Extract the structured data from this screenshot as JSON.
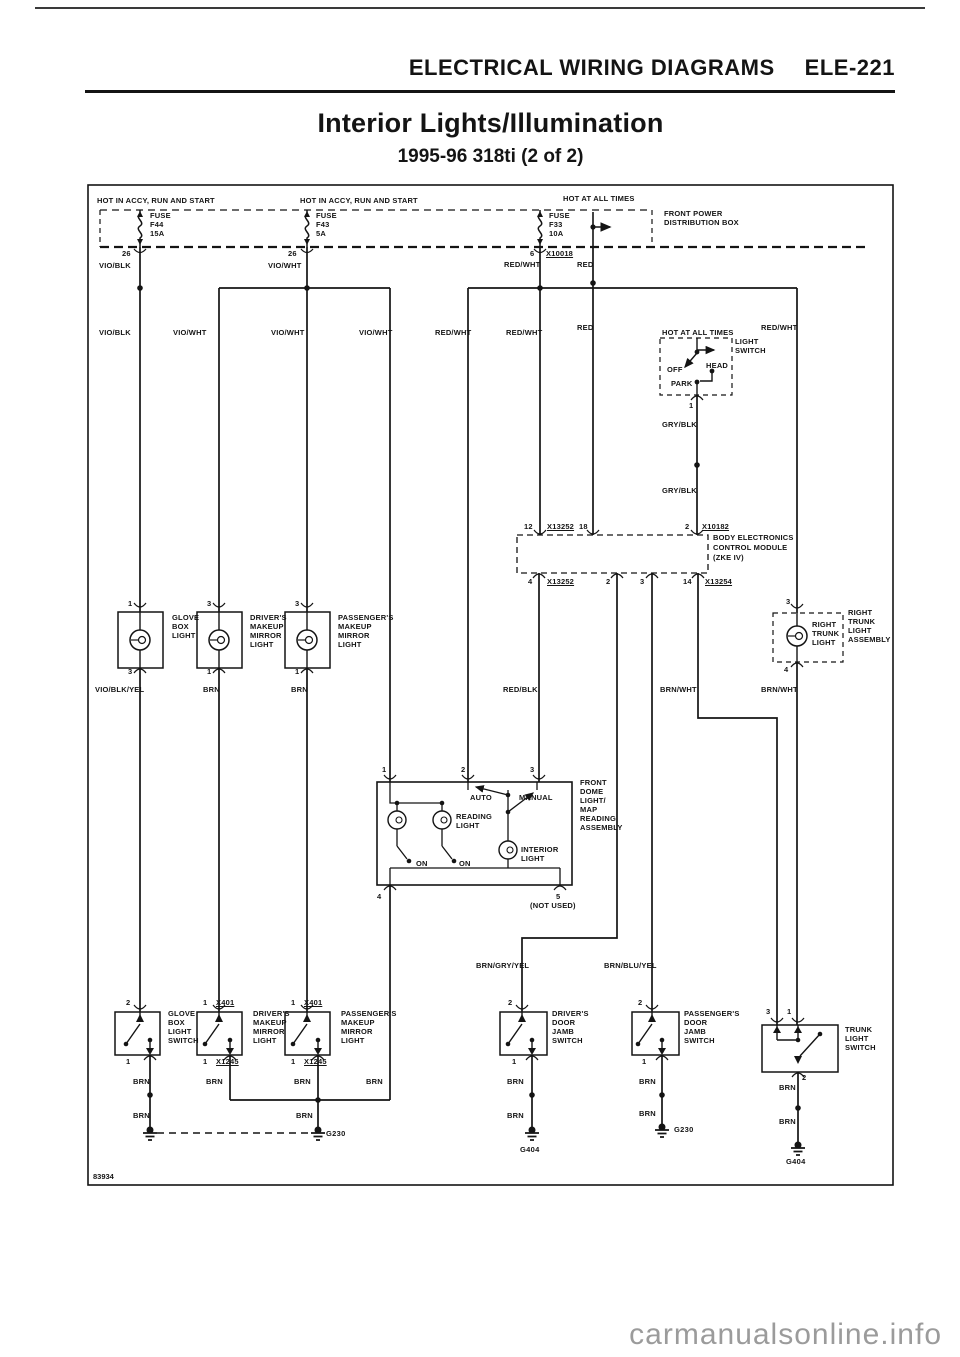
{
  "page": {
    "header": "ELECTRICAL WIRING DIAGRAMS",
    "page_code": "ELE-221",
    "title": "Interior Lights/Illumination",
    "subtitle": "1995-96 318ti (2 of 2)",
    "figure_number": "83934",
    "watermark": "carmanualsonline.info"
  },
  "diagram": {
    "components": [
      "FRONT POWER DISTRIBUTION BOX",
      "LIGHT SWITCH",
      "BODY ELECTRONICS CONTROL MODULE (ZKE IV)",
      "GLOVE BOX LIGHT",
      "DRIVER'S MAKEUP MIRROR LIGHT",
      "PASSENGER'S MAKEUP MIRROR LIGHT",
      "RIGHT TRUNK LIGHT ASSEMBLY",
      "FRONT DOME LIGHT/MAP READING ASSEMBLY",
      "GLOVE BOX LIGHT SWITCH",
      "DRIVER'S DOOR JAMB SWITCH",
      "PASSENGER'S DOOR JAMB SWITCH",
      "TRUNK LIGHT SWITCH"
    ],
    "labels": [
      {
        "t": "HOT IN ACCY, RUN AND START",
        "x": 97,
        "y": 197,
        "c": "p"
      },
      {
        "t": "HOT IN ACCY, RUN AND START",
        "x": 300,
        "y": 197,
        "c": "p"
      },
      {
        "t": "HOT AT ALL TIMES",
        "x": 563,
        "y": 195,
        "c": "p"
      },
      {
        "t": "FUSE",
        "x": 150,
        "y": 212,
        "c": "f"
      },
      {
        "t": "F44",
        "x": 150,
        "y": 221,
        "c": "f"
      },
      {
        "t": "15A",
        "x": 150,
        "y": 230,
        "c": "f"
      },
      {
        "t": "FUSE",
        "x": 316,
        "y": 212,
        "c": "f"
      },
      {
        "t": "F43",
        "x": 316,
        "y": 221,
        "c": "f"
      },
      {
        "t": "5A",
        "x": 316,
        "y": 230,
        "c": "f"
      },
      {
        "t": "FUSE",
        "x": 549,
        "y": 212,
        "c": "f"
      },
      {
        "t": "F33",
        "x": 549,
        "y": 221,
        "c": "f"
      },
      {
        "t": "10A",
        "x": 549,
        "y": 230,
        "c": "f"
      },
      {
        "t": "FRONT POWER",
        "x": 664,
        "y": 210,
        "c": "c"
      },
      {
        "t": "DISTRIBUTION BOX",
        "x": 664,
        "y": 219,
        "c": "c"
      },
      {
        "t": "26",
        "x": 122,
        "y": 250,
        "c": "n"
      },
      {
        "t": "26",
        "x": 288,
        "y": 250,
        "c": "n"
      },
      {
        "t": "6",
        "x": 530,
        "y": 250,
        "c": "n"
      },
      {
        "t": "X10018",
        "x": 546,
        "y": 250,
        "c": "x"
      },
      {
        "t": "VIO/BLK",
        "x": 99,
        "y": 262,
        "c": "w"
      },
      {
        "t": "VIO/WHT",
        "x": 268,
        "y": 262,
        "c": "w"
      },
      {
        "t": "RED/WHT",
        "x": 504,
        "y": 261,
        "c": "w"
      },
      {
        "t": "RED",
        "x": 577,
        "y": 261,
        "c": "w"
      },
      {
        "t": "VIO/BLK",
        "x": 99,
        "y": 329,
        "c": "w"
      },
      {
        "t": "VIO/WHT",
        "x": 173,
        "y": 329,
        "c": "w"
      },
      {
        "t": "VIO/WHT",
        "x": 271,
        "y": 329,
        "c": "w"
      },
      {
        "t": "VIO/WHT",
        "x": 359,
        "y": 329,
        "c": "w"
      },
      {
        "t": "RED/WHT",
        "x": 435,
        "y": 329,
        "c": "w"
      },
      {
        "t": "RED/WHT",
        "x": 506,
        "y": 329,
        "c": "w"
      },
      {
        "t": "RED",
        "x": 577,
        "y": 324,
        "c": "w"
      },
      {
        "t": "RED/WHT",
        "x": 761,
        "y": 324,
        "c": "w"
      },
      {
        "t": "HOT AT ALL TIMES",
        "x": 662,
        "y": 329,
        "c": "p"
      },
      {
        "t": "LIGHT",
        "x": 735,
        "y": 338,
        "c": "c"
      },
      {
        "t": "SWITCH",
        "x": 735,
        "y": 347,
        "c": "c"
      },
      {
        "t": "OFF",
        "x": 667,
        "y": 366,
        "c": "m"
      },
      {
        "t": "HEAD",
        "x": 706,
        "y": 362,
        "c": "m"
      },
      {
        "t": "PARK",
        "x": 671,
        "y": 380,
        "c": "m"
      },
      {
        "t": "1",
        "x": 689,
        "y": 402,
        "c": "n"
      },
      {
        "t": "GRY/BLK",
        "x": 662,
        "y": 421,
        "c": "w"
      },
      {
        "t": "GRY/BLK",
        "x": 662,
        "y": 487,
        "c": "w"
      },
      {
        "t": "12",
        "x": 524,
        "y": 523,
        "c": "n"
      },
      {
        "t": "X13252",
        "x": 547,
        "y": 523,
        "c": "x"
      },
      {
        "t": "18",
        "x": 579,
        "y": 523,
        "c": "n"
      },
      {
        "t": "2",
        "x": 685,
        "y": 523,
        "c": "n"
      },
      {
        "t": "X10182",
        "x": 702,
        "y": 523,
        "c": "x"
      },
      {
        "t": "BODY ELECTRONICS",
        "x": 713,
        "y": 534,
        "c": "c"
      },
      {
        "t": "CONTROL MODULE",
        "x": 713,
        "y": 544,
        "c": "c"
      },
      {
        "t": "(ZKE IV)",
        "x": 713,
        "y": 554,
        "c": "c"
      },
      {
        "t": "4",
        "x": 528,
        "y": 578,
        "c": "n"
      },
      {
        "t": "X13252",
        "x": 547,
        "y": 578,
        "c": "x"
      },
      {
        "t": "2",
        "x": 606,
        "y": 578,
        "c": "n"
      },
      {
        "t": "3",
        "x": 640,
        "y": 578,
        "c": "n"
      },
      {
        "t": "14",
        "x": 683,
        "y": 578,
        "c": "n"
      },
      {
        "t": "X13254",
        "x": 705,
        "y": 578,
        "c": "x"
      },
      {
        "t": "3",
        "x": 786,
        "y": 598,
        "c": "n"
      },
      {
        "t": "1",
        "x": 128,
        "y": 600,
        "c": "n"
      },
      {
        "t": "3",
        "x": 207,
        "y": 600,
        "c": "n"
      },
      {
        "t": "3",
        "x": 295,
        "y": 600,
        "c": "n"
      },
      {
        "t": "GLOVE",
        "x": 172,
        "y": 614,
        "c": "c"
      },
      {
        "t": "BOX",
        "x": 172,
        "y": 623,
        "c": "c"
      },
      {
        "t": "LIGHT",
        "x": 172,
        "y": 632,
        "c": "c"
      },
      {
        "t": "DRIVER'S",
        "x": 250,
        "y": 614,
        "c": "c"
      },
      {
        "t": "MAKEUP",
        "x": 250,
        "y": 623,
        "c": "c"
      },
      {
        "t": "MIRROR",
        "x": 250,
        "y": 632,
        "c": "c"
      },
      {
        "t": "LIGHT",
        "x": 250,
        "y": 641,
        "c": "c"
      },
      {
        "t": "PASSENGER'S",
        "x": 338,
        "y": 614,
        "c": "c"
      },
      {
        "t": "MAKEUP",
        "x": 338,
        "y": 623,
        "c": "c"
      },
      {
        "t": "MIRROR",
        "x": 338,
        "y": 632,
        "c": "c"
      },
      {
        "t": "LIGHT",
        "x": 338,
        "y": 641,
        "c": "c"
      },
      {
        "t": "RIGHT",
        "x": 812,
        "y": 621,
        "c": "c"
      },
      {
        "t": "TRUNK",
        "x": 812,
        "y": 630,
        "c": "c"
      },
      {
        "t": "LIGHT",
        "x": 812,
        "y": 639,
        "c": "c"
      },
      {
        "t": "RIGHT",
        "x": 848,
        "y": 609,
        "c": "c"
      },
      {
        "t": "TRUNK",
        "x": 848,
        "y": 618,
        "c": "c"
      },
      {
        "t": "LIGHT",
        "x": 848,
        "y": 627,
        "c": "c"
      },
      {
        "t": "ASSEMBLY",
        "x": 848,
        "y": 636,
        "c": "c"
      },
      {
        "t": "3",
        "x": 128,
        "y": 668,
        "c": "n"
      },
      {
        "t": "1",
        "x": 207,
        "y": 668,
        "c": "n"
      },
      {
        "t": "1",
        "x": 295,
        "y": 668,
        "c": "n"
      },
      {
        "t": "4",
        "x": 784,
        "y": 666,
        "c": "n"
      },
      {
        "t": "VIO/BLK/YEL",
        "x": 95,
        "y": 686,
        "c": "w"
      },
      {
        "t": "BRN",
        "x": 203,
        "y": 686,
        "c": "w"
      },
      {
        "t": "BRN",
        "x": 291,
        "y": 686,
        "c": "w"
      },
      {
        "t": "RED/BLK",
        "x": 503,
        "y": 686,
        "c": "w"
      },
      {
        "t": "BRN/WHT",
        "x": 660,
        "y": 686,
        "c": "w"
      },
      {
        "t": "BRN/WHT",
        "x": 761,
        "y": 686,
        "c": "w"
      },
      {
        "t": "1",
        "x": 382,
        "y": 766,
        "c": "n"
      },
      {
        "t": "2",
        "x": 461,
        "y": 766,
        "c": "n"
      },
      {
        "t": "3",
        "x": 530,
        "y": 766,
        "c": "n"
      },
      {
        "t": "FRONT",
        "x": 580,
        "y": 779,
        "c": "c"
      },
      {
        "t": "DOME",
        "x": 580,
        "y": 788,
        "c": "c"
      },
      {
        "t": "LIGHT/",
        "x": 580,
        "y": 797,
        "c": "c"
      },
      {
        "t": "MAP",
        "x": 580,
        "y": 806,
        "c": "c"
      },
      {
        "t": "READING",
        "x": 580,
        "y": 815,
        "c": "c"
      },
      {
        "t": "ASSEMBLY",
        "x": 580,
        "y": 824,
        "c": "c"
      },
      {
        "t": "AUTO",
        "x": 470,
        "y": 794,
        "c": "m"
      },
      {
        "t": "MANUAL",
        "x": 519,
        "y": 794,
        "c": "m"
      },
      {
        "t": "READING",
        "x": 456,
        "y": 813,
        "c": "c"
      },
      {
        "t": "LIGHT",
        "x": 456,
        "y": 822,
        "c": "c"
      },
      {
        "t": "ON",
        "x": 416,
        "y": 860,
        "c": "m"
      },
      {
        "t": "ON",
        "x": 459,
        "y": 860,
        "c": "m"
      },
      {
        "t": "INTERIOR",
        "x": 521,
        "y": 846,
        "c": "c"
      },
      {
        "t": "LIGHT",
        "x": 521,
        "y": 855,
        "c": "c"
      },
      {
        "t": "4",
        "x": 377,
        "y": 893,
        "c": "n"
      },
      {
        "t": "5",
        "x": 556,
        "y": 893,
        "c": "n"
      },
      {
        "t": "(NOT USED)",
        "x": 530,
        "y": 902,
        "c": "m"
      },
      {
        "t": "BRN/GRY/YEL",
        "x": 476,
        "y": 962,
        "c": "w"
      },
      {
        "t": "BRN/BLU/YEL",
        "x": 604,
        "y": 962,
        "c": "w"
      },
      {
        "t": "2",
        "x": 126,
        "y": 999,
        "c": "n"
      },
      {
        "t": "1",
        "x": 203,
        "y": 999,
        "c": "n"
      },
      {
        "t": "X401",
        "x": 216,
        "y": 999,
        "c": "x"
      },
      {
        "t": "1",
        "x": 291,
        "y": 999,
        "c": "n"
      },
      {
        "t": "X401",
        "x": 304,
        "y": 999,
        "c": "x"
      },
      {
        "t": "2",
        "x": 508,
        "y": 999,
        "c": "n"
      },
      {
        "t": "2",
        "x": 638,
        "y": 999,
        "c": "n"
      },
      {
        "t": "3",
        "x": 766,
        "y": 1008,
        "c": "n"
      },
      {
        "t": "1",
        "x": 787,
        "y": 1008,
        "c": "n"
      },
      {
        "t": "GLOVE",
        "x": 168,
        "y": 1010,
        "c": "c"
      },
      {
        "t": "BOX",
        "x": 168,
        "y": 1019,
        "c": "c"
      },
      {
        "t": "LIGHT",
        "x": 168,
        "y": 1028,
        "c": "c"
      },
      {
        "t": "SWITCH",
        "x": 168,
        "y": 1037,
        "c": "c"
      },
      {
        "t": "DRIVER'S",
        "x": 253,
        "y": 1010,
        "c": "c"
      },
      {
        "t": "MAKEUP",
        "x": 253,
        "y": 1019,
        "c": "c"
      },
      {
        "t": "MIRROR",
        "x": 253,
        "y": 1028,
        "c": "c"
      },
      {
        "t": "LIGHT",
        "x": 253,
        "y": 1037,
        "c": "c"
      },
      {
        "t": "PASSENGER'S",
        "x": 341,
        "y": 1010,
        "c": "c"
      },
      {
        "t": "MAKEUP",
        "x": 341,
        "y": 1019,
        "c": "c"
      },
      {
        "t": "MIRROR",
        "x": 341,
        "y": 1028,
        "c": "c"
      },
      {
        "t": "LIGHT",
        "x": 341,
        "y": 1037,
        "c": "c"
      },
      {
        "t": "DRIVER'S",
        "x": 552,
        "y": 1010,
        "c": "c"
      },
      {
        "t": "DOOR",
        "x": 552,
        "y": 1019,
        "c": "c"
      },
      {
        "t": "JAMB",
        "x": 552,
        "y": 1028,
        "c": "c"
      },
      {
        "t": "SWITCH",
        "x": 552,
        "y": 1037,
        "c": "c"
      },
      {
        "t": "PASSENGER'S",
        "x": 684,
        "y": 1010,
        "c": "c"
      },
      {
        "t": "DOOR",
        "x": 684,
        "y": 1019,
        "c": "c"
      },
      {
        "t": "JAMB",
        "x": 684,
        "y": 1028,
        "c": "c"
      },
      {
        "t": "SWITCH",
        "x": 684,
        "y": 1037,
        "c": "c"
      },
      {
        "t": "TRUNK",
        "x": 845,
        "y": 1026,
        "c": "c"
      },
      {
        "t": "LIGHT",
        "x": 845,
        "y": 1035,
        "c": "c"
      },
      {
        "t": "SWITCH",
        "x": 845,
        "y": 1044,
        "c": "c"
      },
      {
        "t": "1",
        "x": 126,
        "y": 1058,
        "c": "n"
      },
      {
        "t": "1",
        "x": 203,
        "y": 1058,
        "c": "n"
      },
      {
        "t": "X1245",
        "x": 216,
        "y": 1058,
        "c": "x"
      },
      {
        "t": "1",
        "x": 291,
        "y": 1058,
        "c": "n"
      },
      {
        "t": "X1245",
        "x": 304,
        "y": 1058,
        "c": "x"
      },
      {
        "t": "1",
        "x": 512,
        "y": 1058,
        "c": "n"
      },
      {
        "t": "1",
        "x": 642,
        "y": 1058,
        "c": "n"
      },
      {
        "t": "2",
        "x": 802,
        "y": 1074,
        "c": "n"
      },
      {
        "t": "BRN",
        "x": 133,
        "y": 1078,
        "c": "w"
      },
      {
        "t": "BRN",
        "x": 206,
        "y": 1078,
        "c": "w"
      },
      {
        "t": "BRN",
        "x": 294,
        "y": 1078,
        "c": "w"
      },
      {
        "t": "BRN",
        "x": 366,
        "y": 1078,
        "c": "w"
      },
      {
        "t": "BRN",
        "x": 507,
        "y": 1078,
        "c": "w"
      },
      {
        "t": "BRN",
        "x": 639,
        "y": 1078,
        "c": "w"
      },
      {
        "t": "BRN",
        "x": 779,
        "y": 1084,
        "c": "w"
      },
      {
        "t": "BRN",
        "x": 133,
        "y": 1112,
        "c": "w"
      },
      {
        "t": "BRN",
        "x": 296,
        "y": 1112,
        "c": "w"
      },
      {
        "t": "BRN",
        "x": 507,
        "y": 1112,
        "c": "w"
      },
      {
        "t": "BRN",
        "x": 639,
        "y": 1110,
        "c": "w"
      },
      {
        "t": "BRN",
        "x": 779,
        "y": 1118,
        "c": "w"
      },
      {
        "t": "G230",
        "x": 326,
        "y": 1130,
        "c": "g"
      },
      {
        "t": "G404",
        "x": 520,
        "y": 1146,
        "c": "g"
      },
      {
        "t": "G230",
        "x": 674,
        "y": 1126,
        "c": "g"
      },
      {
        "t": "G404",
        "x": 786,
        "y": 1158,
        "c": "g"
      }
    ]
  }
}
